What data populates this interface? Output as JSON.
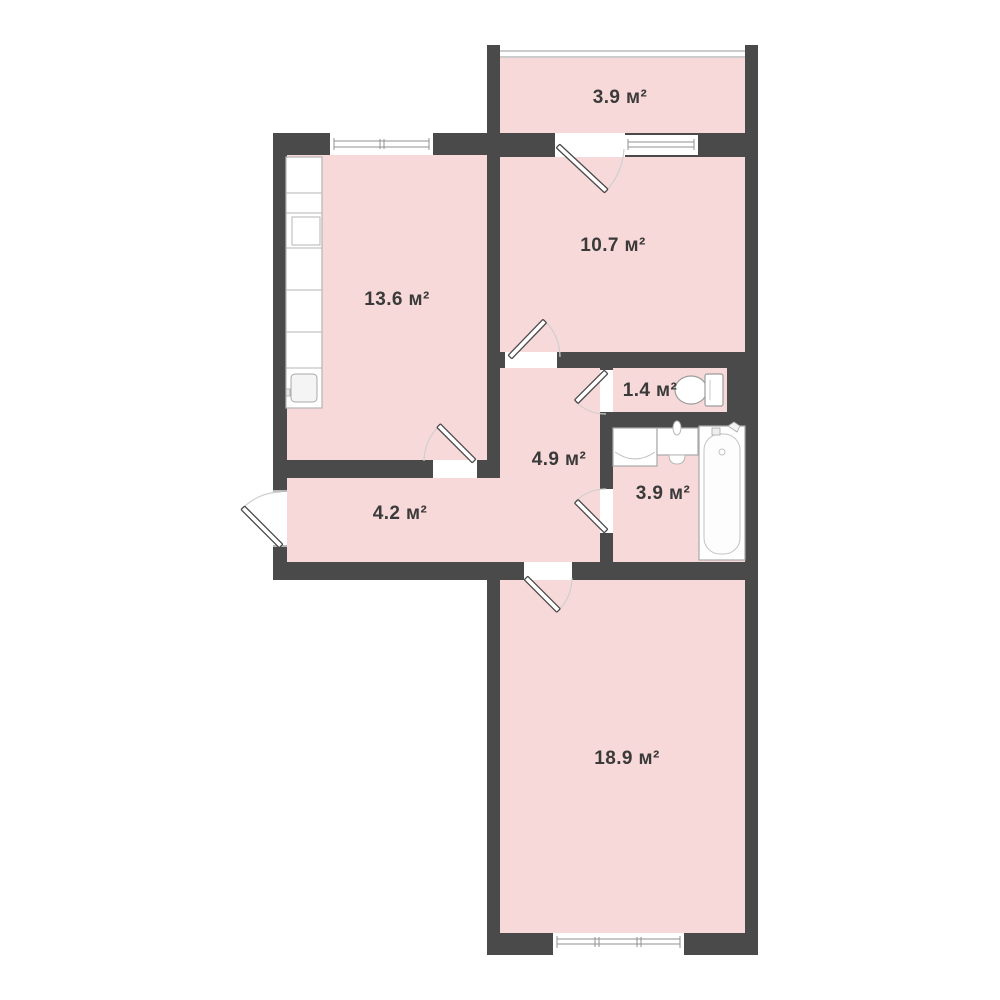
{
  "floorplan": {
    "title": "apartment-floor-plan",
    "unit_suffix": "м²",
    "rooms": [
      {
        "name": "balcony",
        "area": "3.9",
        "label": "3.9 м²"
      },
      {
        "name": "bedroom",
        "area": "10.7",
        "label": "10.7 м²"
      },
      {
        "name": "kitchen",
        "area": "13.6",
        "label": "13.6 м²"
      },
      {
        "name": "wc",
        "area": "1.4",
        "label": "1.4 м²"
      },
      {
        "name": "hallway",
        "area": "4.9",
        "label": "4.9 м²"
      },
      {
        "name": "bathroom",
        "area": "3.9",
        "label": "3.9 м²"
      },
      {
        "name": "corridor",
        "area": "4.2",
        "label": "4.2 м²"
      },
      {
        "name": "living-room",
        "area": "18.9",
        "label": "18.9 м²"
      }
    ],
    "colors": {
      "wall": "#4a4a4a",
      "room_fill": "#f8d9d9",
      "background": "#ffffff",
      "fixture_outline": "#a8a8a8",
      "door_arc": "#cfcfcf",
      "label_text": "#3a3a3a"
    }
  }
}
